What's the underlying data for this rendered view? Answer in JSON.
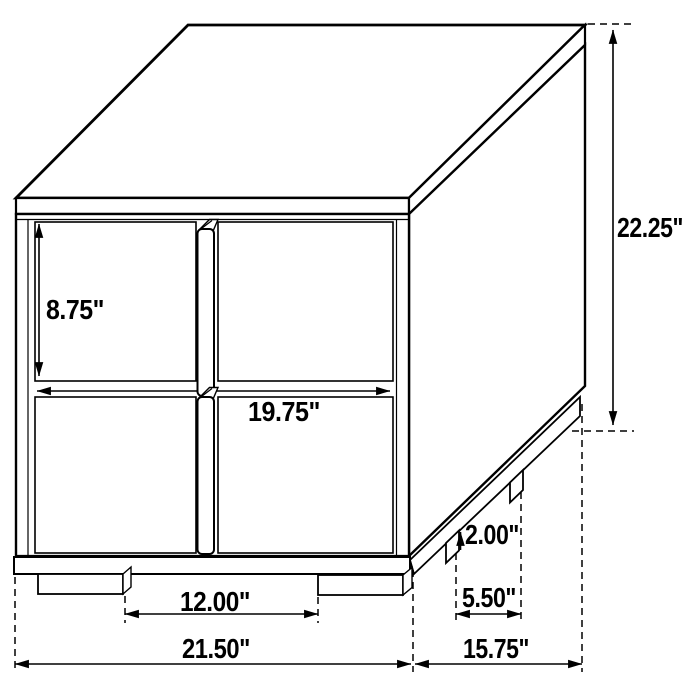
{
  "diagram": {
    "subject": "two-drawer nightstand dimension drawing",
    "unit": "inches",
    "colors": {
      "line": "#000000",
      "background": "#ffffff"
    },
    "labels": {
      "drawer_height": "8.75\"",
      "overall_height": "22.25\"",
      "front_drawer_width": "19.75\"",
      "front_feet_spacing": "12.00\"",
      "overall_width": "21.50\"",
      "overall_depth": "15.75\"",
      "side_feet_spacing": "5.50\"",
      "foot_height": "2.00\""
    }
  }
}
